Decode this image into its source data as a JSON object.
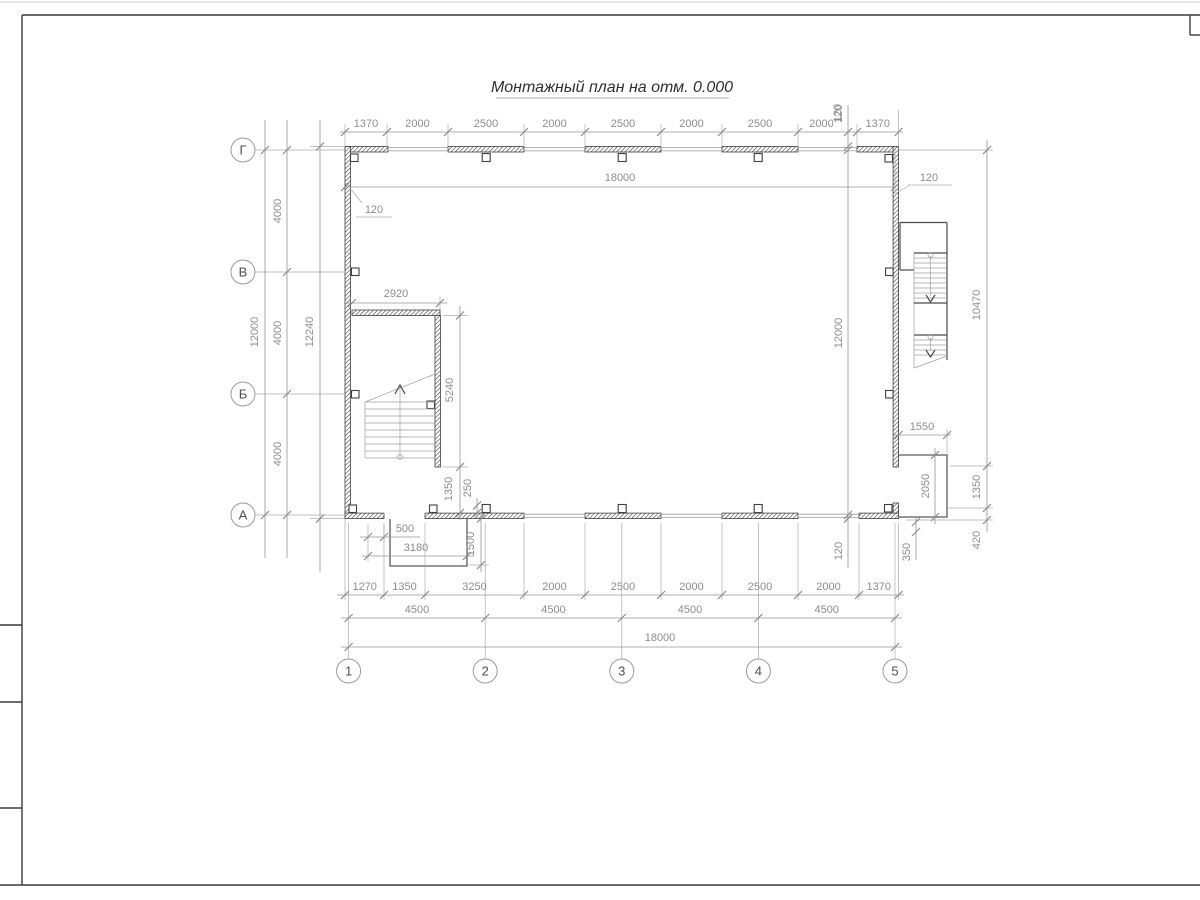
{
  "title": "Монтажный план на отм. 0.000",
  "axes": {
    "rows": [
      "Г",
      "В",
      "Б",
      "А"
    ],
    "cols": [
      "1",
      "2",
      "3",
      "4",
      "5"
    ]
  },
  "dims": {
    "top_chain": [
      "1370",
      "2000",
      "2500",
      "2000",
      "2500",
      "2000",
      "2500",
      "2000",
      "1370"
    ],
    "top_offset_120": "120",
    "inner_width": "18000",
    "wall_120_left": "120",
    "wall_120_right": "120",
    "left_total": "12000",
    "left_bays": [
      "4000",
      "4000",
      "4000"
    ],
    "left_overall": "12240",
    "right_inner_height": "12000",
    "right_offset_top": "120",
    "right_offset_bottom": "120",
    "right_outer_span": "10470",
    "right_porch_width": "1550",
    "right_porch_depth": "2050",
    "right_edge_upper": "1350",
    "right_edge_lower": "420",
    "right_wall_gap": "350",
    "stair_width": "2920",
    "stair_length": "5240",
    "stair_gap": "1350",
    "stair_offset": "250",
    "left_porch_step": "500",
    "left_porch_width": "3180",
    "left_porch_depth": "1500",
    "bottom_chain": [
      "1270",
      "1350",
      "3250",
      "2000",
      "2500",
      "2000",
      "2500",
      "2000",
      "1370"
    ],
    "bottom_bays": [
      "4500",
      "4500",
      "4500",
      "4500"
    ],
    "bottom_total": "18000"
  }
}
